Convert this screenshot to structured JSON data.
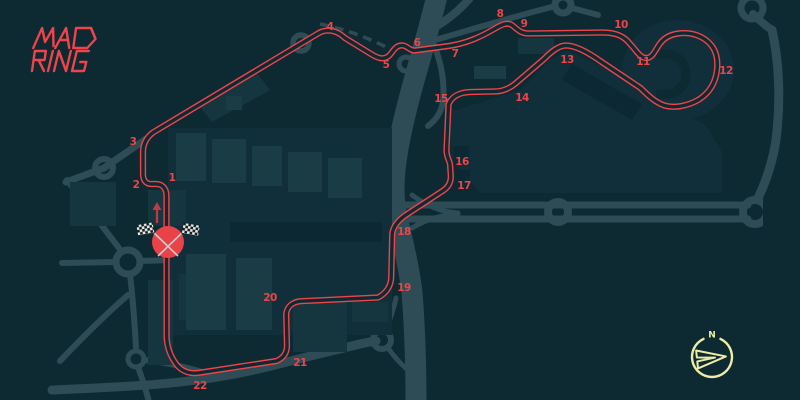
{
  "page_title": "MADRING circuit map",
  "logo": {
    "line1": "MAD",
    "line2": "RING",
    "label": "MADRING"
  },
  "compass": {
    "north_label": "N"
  },
  "corners": [
    {
      "label": "1"
    },
    {
      "label": "2"
    },
    {
      "label": "3"
    },
    {
      "label": "4"
    },
    {
      "label": "5"
    },
    {
      "label": "6"
    },
    {
      "label": "7"
    },
    {
      "label": "8"
    },
    {
      "label": "9"
    },
    {
      "label": "10"
    },
    {
      "label": "11"
    },
    {
      "label": "12"
    },
    {
      "label": "13"
    },
    {
      "label": "14"
    },
    {
      "label": "15"
    },
    {
      "label": "16"
    },
    {
      "label": "17"
    },
    {
      "label": "18"
    },
    {
      "label": "19"
    },
    {
      "label": "20"
    },
    {
      "label": "21"
    },
    {
      "label": "22"
    }
  ],
  "colors": {
    "background": "#0d2a33",
    "track_red": "#ef4449",
    "road": "#2d4c55",
    "building": "#16363f",
    "building_light": "#1a3c45",
    "building_dark": "#0c2933",
    "campus_base": "#112f3a",
    "flag_circle": "#e94349",
    "direction_arrow": "#c23a41",
    "compass_yellow": "#efeda5",
    "flag_checker_light": "#e9ebea",
    "flag_checker_dark": "#141d1f"
  }
}
